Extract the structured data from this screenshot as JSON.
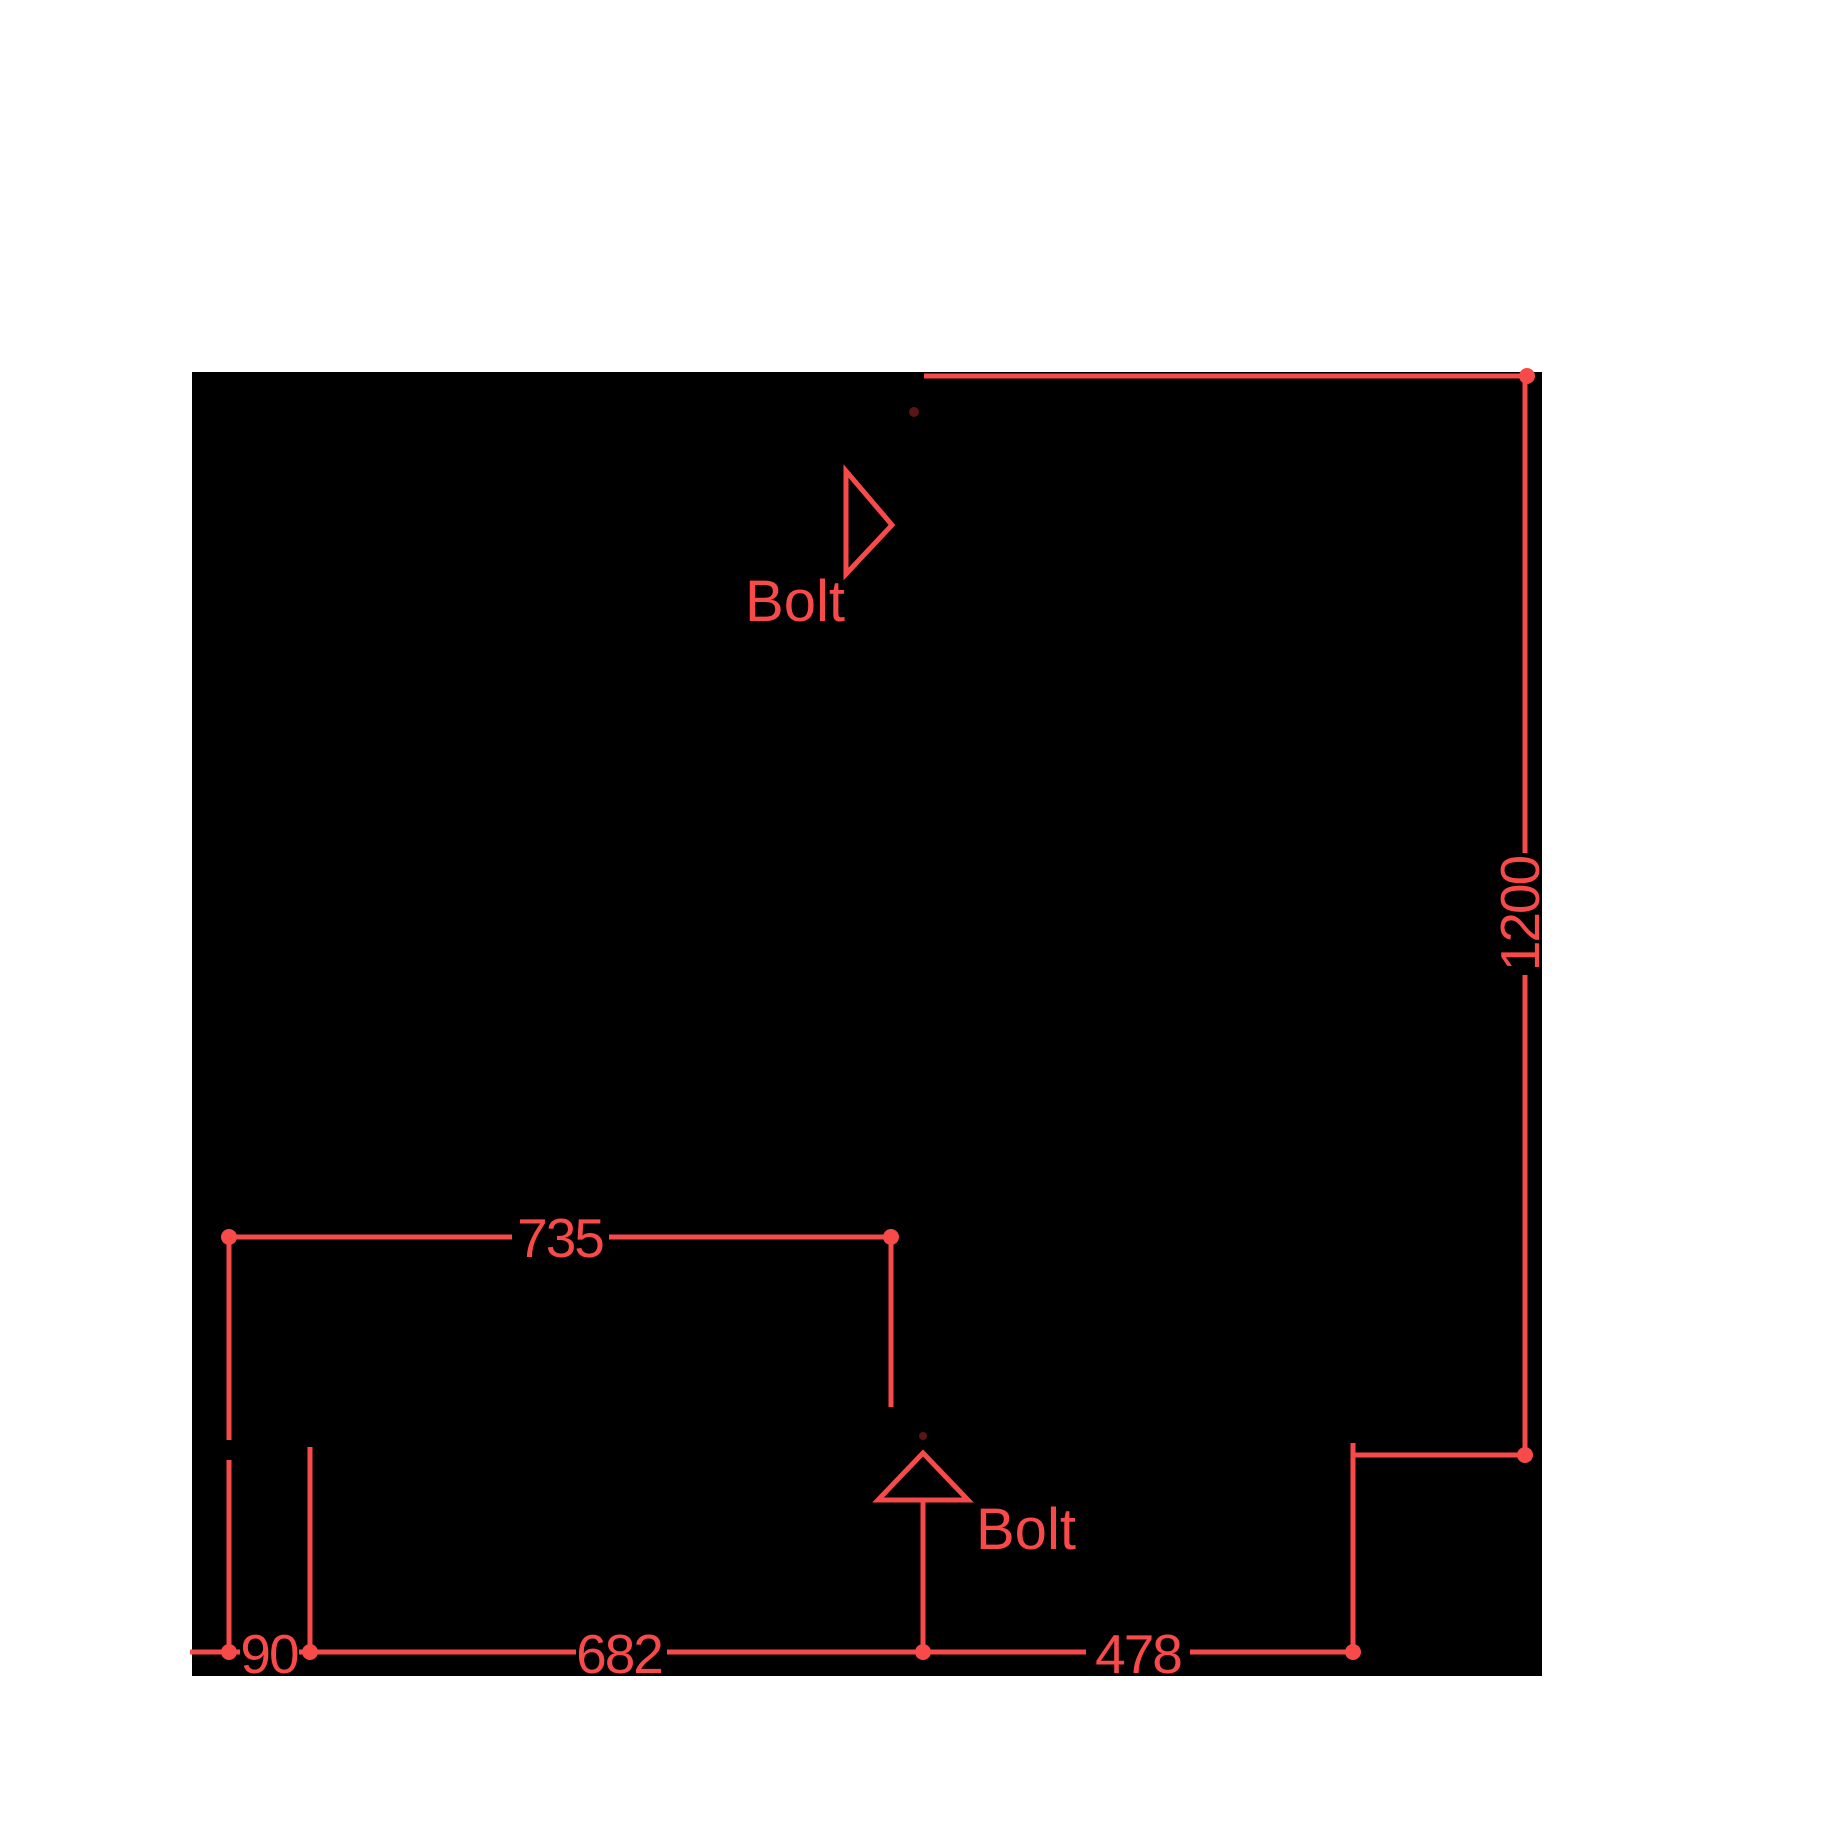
{
  "colors": {
    "background": "#ffffff",
    "silhouette": "#000000",
    "annotation": "#f94a4a",
    "hidden_marker": "#5a1515"
  },
  "dimensions": [
    {
      "id": "vertical-right",
      "label": "1200",
      "value": 1200,
      "orientation": "vertical"
    },
    {
      "id": "width-mid-left",
      "label": "735",
      "value": 735,
      "orientation": "horizontal"
    },
    {
      "id": "bottom-offset",
      "label": "90",
      "value": 90,
      "orientation": "horizontal"
    },
    {
      "id": "bottom-center",
      "label": "682",
      "value": 682,
      "orientation": "horizontal"
    },
    {
      "id": "bottom-right",
      "label": "478",
      "value": 478,
      "orientation": "horizontal"
    }
  ],
  "annotations": [
    {
      "id": "bolt-top",
      "label": "Bolt"
    },
    {
      "id": "bolt-bottom",
      "label": "Bolt"
    }
  ]
}
